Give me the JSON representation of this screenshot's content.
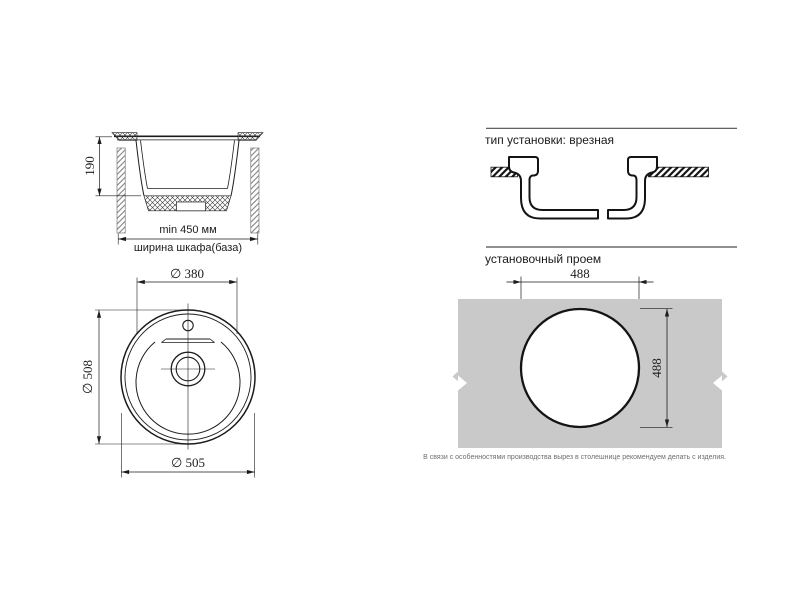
{
  "drawing": {
    "section_view": {
      "depth_dim": "190",
      "cabinet_min_width": "min 450 мм",
      "cabinet_width_label": "ширина шкафа(база)"
    },
    "top_view": {
      "bowl_diameter": "∅ 380",
      "outer_diameter_vertical": "∅ 508",
      "outer_diameter_horizontal": "∅ 505"
    },
    "install_type": {
      "title": "тип установки: врезная"
    },
    "cutout": {
      "title": "установочный проем",
      "width": "488",
      "height": "488",
      "note": "В связи с особенностями производства вырез в столешнице рекомендуем делать с изделия."
    },
    "colors": {
      "line": "#1c1c1c",
      "countertop_gray": "#c9c9c9",
      "note_gray": "#6e6e6e",
      "rule_gray": "#4c4c4c"
    }
  }
}
